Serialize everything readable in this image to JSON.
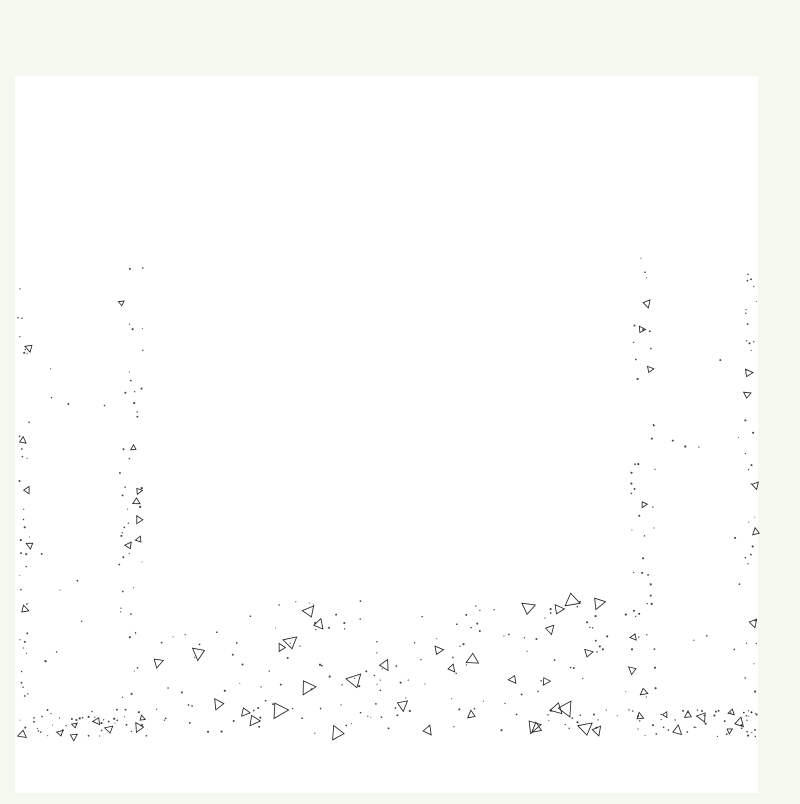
{
  "canvas": {
    "w": 800,
    "h": 800,
    "margin_color": "#f5f8ef",
    "paper_color": "#ffffff",
    "ink": "#1a1a1a",
    "paper_rect": [
      15,
      76,
      743,
      717
    ]
  },
  "labels": {
    "steam_left": {
      "text": "1、蒸汽供应系统",
      "x": 84,
      "y": 150,
      "size": 10,
      "anchor": "start",
      "underline": [
        70,
        153.5,
        173,
        153.5
      ],
      "leader": [
        70,
        153.5,
        62,
        414
      ]
    },
    "sensors": {
      "text": "3、气温、水温、水位传感器",
      "x": 167,
      "y": 210,
      "size": 8.5,
      "anchor": "start",
      "underline": [
        154,
        213.5,
        268,
        213.5
      ],
      "leader": [
        154,
        213.5,
        151,
        264
      ],
      "arrow": [
        151,
        267,
        147,
        258,
        156,
        260
      ]
    },
    "steam_right": {
      "text": "1、蒸汽供应系统",
      "x": 798,
      "y": 150,
      "size": 7.5,
      "anchor": "end",
      "underline": [
        737,
        153.5,
        798,
        153.5
      ],
      "leader": [
        739,
        153.5,
        720,
        414
      ]
    }
  },
  "pier": {
    "mirror_axis": 775,
    "lines": [
      [
        17,
        248,
        17,
        740,
        1.3
      ],
      [
        17,
        248,
        123,
        248,
        1.3
      ],
      [
        31,
        256,
        118,
        256,
        1
      ],
      [
        123,
        248,
        123,
        256,
        1
      ],
      [
        31,
        256,
        31,
        700,
        1
      ],
      [
        118,
        250,
        118,
        700,
        1
      ],
      [
        122,
        252,
        122,
        700,
        0.8
      ],
      [
        145,
        252,
        145,
        583,
        1
      ],
      [
        150,
        252,
        150,
        583,
        1
      ],
      [
        30,
        515,
        112,
        515,
        0.9
      ],
      [
        30,
        562,
        152,
        562,
        0.9
      ],
      [
        30,
        700,
        118,
        700,
        1.1
      ],
      [
        52,
        640,
        168,
        640,
        1
      ],
      [
        52,
        647,
        168,
        647,
        1
      ],
      [
        100,
        368,
        100,
        636,
        0.9
      ],
      [
        107,
        368,
        107,
        636,
        0.9
      ],
      [
        57,
        503,
        57,
        632,
        0.9
      ],
      [
        108,
        384,
        152,
        384,
        0.9
      ],
      [
        108,
        388,
        152,
        388,
        2
      ],
      [
        108,
        392,
        152,
        392,
        0.9
      ],
      [
        108,
        454,
        152,
        454,
        0.9
      ],
      [
        108,
        458,
        152,
        458,
        2
      ],
      [
        108,
        462,
        152,
        462,
        0.9
      ]
    ],
    "dashed_lines": [
      [
        86,
        415,
        86,
        628,
        0.9,
        "10 6"
      ],
      [
        93,
        415,
        93,
        628,
        0.9,
        "10 6"
      ]
    ],
    "rects": [
      [
        45,
        415,
        22,
        103
      ],
      [
        50,
        437,
        12,
        81
      ],
      [
        32,
        700,
        85,
        7
      ],
      [
        74,
        630,
        14,
        24
      ],
      [
        99,
        377,
        8,
        22
      ],
      [
        108,
        381,
        7,
        14
      ],
      [
        127,
        379,
        6,
        18
      ],
      [
        99,
        447,
        8,
        22
      ],
      [
        108,
        451,
        7,
        14
      ],
      [
        127,
        449,
        6,
        18
      ]
    ],
    "filled_rects": [
      [
        128,
        277,
        23,
        5
      ],
      [
        128,
        284,
        23,
        2
      ],
      [
        150,
        321,
        9,
        11
      ],
      [
        137,
        382,
        12,
        12
      ],
      [
        137,
        452,
        12,
        12
      ]
    ],
    "ellipses": [
      [
        57,
        491,
        7,
        11
      ],
      [
        57,
        493,
        3.5,
        6
      ]
    ],
    "circles": [
      [
        81,
        642,
        4.5
      ]
    ],
    "paths": [
      "M122,281 C112,295 101,308 97,322 C94,332 92,342 92,352",
      "M127,249 L131,255 L135,248"
    ]
  },
  "gate": {
    "lines": [
      [
        150,
        302,
        625,
        302,
        1
      ],
      [
        150,
        321,
        625,
        321,
        1
      ],
      [
        150,
        332,
        625,
        332,
        1
      ],
      [
        285,
        325,
        490,
        325,
        0.8
      ],
      [
        285,
        329,
        490,
        329,
        0.8
      ],
      [
        150,
        573,
        625,
        573,
        1.5
      ],
      [
        150,
        578,
        625,
        578,
        1.5
      ],
      [
        150,
        565,
        150,
        583,
        1.2
      ],
      [
        625,
        565,
        625,
        583,
        1.2
      ]
    ],
    "filled_rects": [
      [
        152,
        322,
        133,
        9
      ],
      [
        490,
        322,
        132,
        9
      ]
    ]
  },
  "spray": {
    "mirror_axis": 773,
    "rows_y": [
      381,
      458
    ],
    "pipe_x": [
      190,
      370
    ],
    "nozzle_x": [
      205,
      257,
      308,
      362
    ],
    "feed_x": [
      283,
      288
    ],
    "vert_top": 353,
    "vert_bottom": 505
  },
  "basin": {
    "dash_line": [
      75,
      596,
      728,
      596,
      1.6,
      "20 9"
    ],
    "bottom_line": [
      17,
      740,
      758,
      740,
      1.6
    ],
    "breaks": [
      128,
      383,
      645
    ],
    "center_line": [
      386,
      268,
      386,
      795,
      0.9
    ]
  },
  "texture": {
    "regions": [
      [
        18,
        258,
        12,
        478,
        36,
        5,
        3,
        5
      ],
      [
        119,
        258,
        25,
        440,
        44,
        7,
        3,
        5
      ],
      [
        18,
        709,
        130,
        28,
        40,
        8,
        3,
        6
      ],
      [
        631,
        258,
        25,
        440,
        44,
        7,
        3,
        5
      ],
      [
        745,
        258,
        12,
        478,
        36,
        5,
        3,
        5
      ],
      [
        628,
        709,
        128,
        28,
        40,
        8,
        3,
        6
      ],
      [
        154,
        600,
        472,
        134,
        150,
        34,
        4,
        9
      ],
      [
        33,
        268,
        80,
        420,
        10,
        0,
        3,
        4
      ],
      [
        662,
        268,
        80,
        420,
        10,
        0,
        3,
        4
      ]
    ],
    "edge_flags": [
      [
        23,
        345
      ],
      [
        23,
        505
      ],
      [
        23,
        648
      ],
      [
        23,
        714
      ],
      [
        752,
        383
      ],
      [
        752,
        587
      ],
      [
        752,
        690
      ],
      [
        752,
        716
      ],
      [
        126,
        412
      ],
      [
        640,
        560
      ]
    ]
  }
}
